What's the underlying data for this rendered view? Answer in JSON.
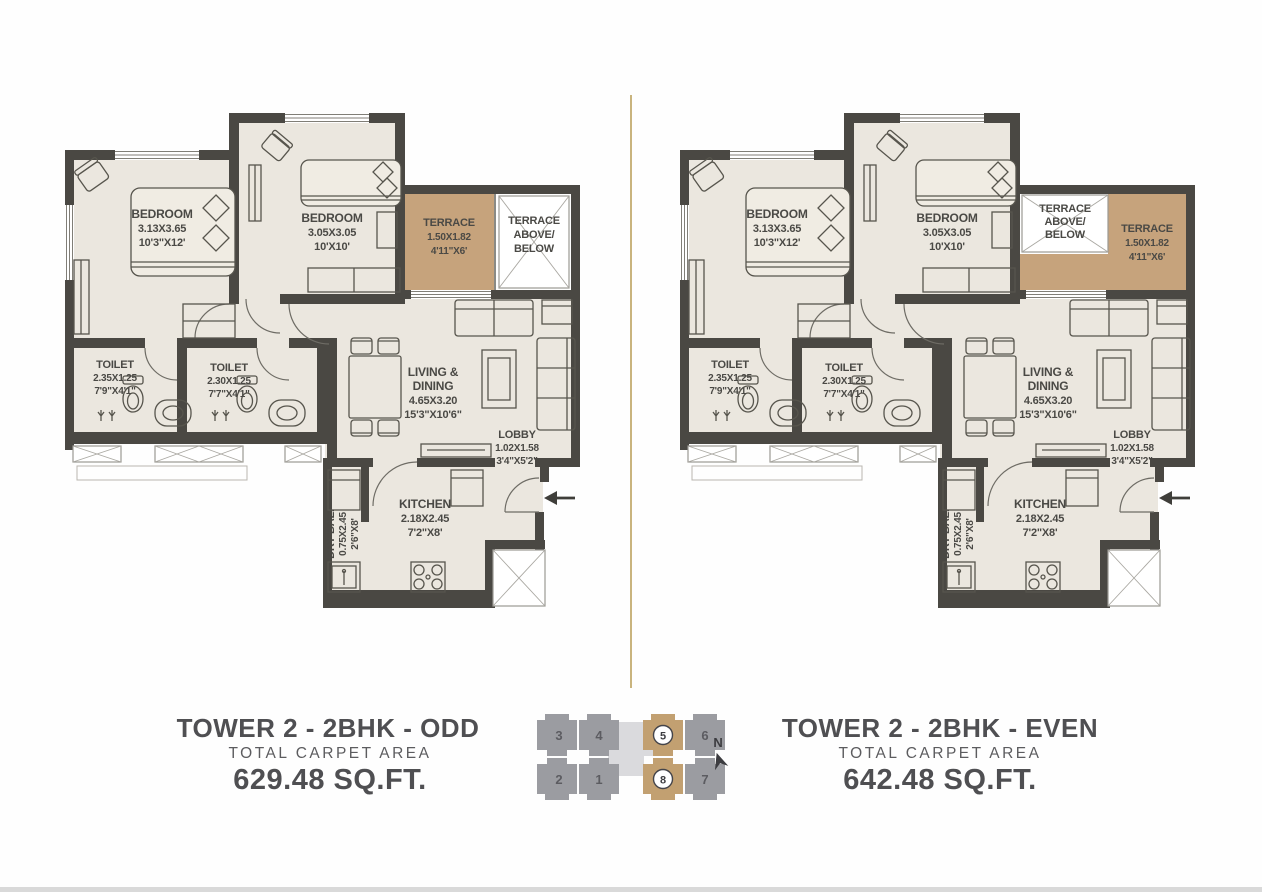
{
  "colors": {
    "wall": "#4a4843",
    "floor": "#ebe7df",
    "terrace": "#c6a37c",
    "divider": "#c9b47e",
    "keyplan_gray": "#9b9ca1",
    "keyplan_tan": "#c2a071",
    "keyplan_light": "#dadadd"
  },
  "plans": [
    {
      "id": "odd",
      "title": "TOWER 2 - 2BHK - ODD",
      "subtitle": "TOTAL CARPET AREA",
      "area": "629.48 SQ.FT.",
      "rooms": {
        "bedroom1": {
          "name": "BEDROOM",
          "dim_m": "3.13X3.65",
          "dim_ft": "10'3\"X12'"
        },
        "bedroom2": {
          "name": "BEDROOM",
          "dim_m": "3.05X3.05",
          "dim_ft": "10'X10'"
        },
        "terrace": {
          "name": "TERRACE",
          "dim_m": "1.50X1.82",
          "dim_ft": "4'11\"X6'"
        },
        "terrace_void": {
          "l1": "TERRACE",
          "l2": "ABOVE/",
          "l3": "BELOW"
        },
        "toilet1": {
          "name": "TOILET",
          "dim_m": "2.35X1.25",
          "dim_ft": "7'9\"X4'1\""
        },
        "toilet2": {
          "name": "TOILET",
          "dim_m": "2.30X1.25",
          "dim_ft": "7'7\"X4'1\""
        },
        "living": {
          "l1": "LIVING &",
          "l2": "DINING",
          "dim_m": "4.65X3.20",
          "dim_ft": "15'3\"X10'6\""
        },
        "lobby": {
          "name": "LOBBY",
          "dim_m": "1.02X1.58",
          "dim_ft": "3'4\"X5'2\""
        },
        "kitchen": {
          "name": "KITCHEN",
          "dim_m": "2.18X2.45",
          "dim_ft": "7'2\"X8'"
        },
        "drybal": {
          "name": "DRY BAL.",
          "dim_m": "0.75X2.45",
          "dim_ft": "2'6\"X8'"
        }
      }
    },
    {
      "id": "even",
      "title": "TOWER 2 - 2BHK - EVEN",
      "subtitle": "TOTAL CARPET AREA",
      "area": "642.48 SQ.FT.",
      "rooms": {
        "bedroom1": {
          "name": "BEDROOM",
          "dim_m": "3.13X3.65",
          "dim_ft": "10'3\"X12'"
        },
        "bedroom2": {
          "name": "BEDROOM",
          "dim_m": "3.05X3.05",
          "dim_ft": "10'X10'"
        },
        "terrace": {
          "name": "TERRACE",
          "dim_m": "1.50X1.82",
          "dim_ft": "4'11\"X6'"
        },
        "terrace_void": {
          "l1": "TERRACE",
          "l2": "ABOVE/",
          "l3": "BELOW"
        },
        "toilet1": {
          "name": "TOILET",
          "dim_m": "2.35X1.25",
          "dim_ft": "7'9\"X4'1\""
        },
        "toilet2": {
          "name": "TOILET",
          "dim_m": "2.30X1.25",
          "dim_ft": "7'7\"X4'1\""
        },
        "living": {
          "l1": "LIVING &",
          "l2": "DINING",
          "dim_m": "4.65X3.20",
          "dim_ft": "15'3\"X10'6\""
        },
        "lobby": {
          "name": "LOBBY",
          "dim_m": "1.02X1.58",
          "dim_ft": "3'4\"X5'2\""
        },
        "kitchen": {
          "name": "KITCHEN",
          "dim_m": "2.18X2.45",
          "dim_ft": "7'2\"X8'"
        },
        "drybal": {
          "name": "DRY BAL.",
          "dim_m": "0.75X2.45",
          "dim_ft": "2'6\"X8'"
        }
      }
    }
  ],
  "keyplan": {
    "top": [
      "3",
      "4",
      "5",
      "6"
    ],
    "bottom": [
      "2",
      "1",
      "8",
      "7"
    ],
    "highlighted": [
      "5",
      "8"
    ],
    "north": "N"
  }
}
